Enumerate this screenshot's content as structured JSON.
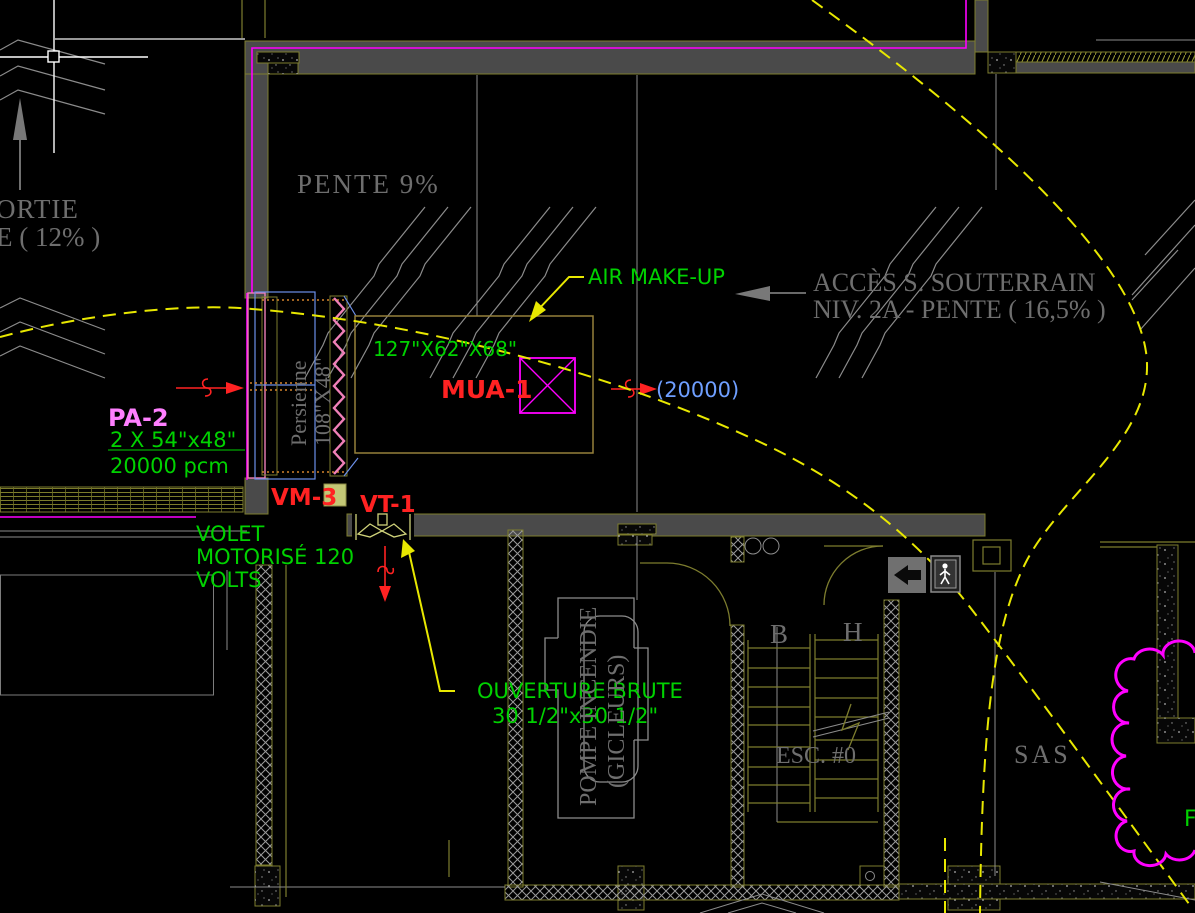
{
  "colors": {
    "bg": "#000000",
    "wall": "#4a4a4a",
    "olive": "#7d7d2e",
    "tan": "#95803a",
    "grayline": "#8c8c8c",
    "graytext": "#6e6e6e",
    "green": "#00d200",
    "red": "#ff2222",
    "violet": "#ff7fff",
    "bluetext": "#6f9fff",
    "blueline": "#6c8fe8",
    "pink": "#f080b8",
    "magenta": "#ff00ff",
    "yellow": "#e8e800",
    "khaki": "#cfd27a",
    "white": "#ffffff"
  },
  "labels": {
    "sortie_partial": "ORTIE",
    "pente12_partial": "E  ( 12% )",
    "pente9": "PENTE  9%",
    "acces_line1": "ACCÈS S. SOUTERRAIN",
    "acces_line2": "NIV. 2A  -  PENTE ( 16,5% )",
    "air_make_up": "AIR MAKE-UP",
    "mua_dims": "127\"X62\"X68\"",
    "mua_tag": "MUA-1",
    "mua_flow": "(20000)",
    "pa2_tag": "PA-2",
    "pa2_size": "2 X 54\"x48\"",
    "pa2_flow": "20000 pcm",
    "vm3_tag": "VM-3",
    "vt1_tag": "VT-1",
    "volet_line1": "VOLET",
    "volet_line2": "MOTORISÉ 120",
    "volet_line3": "VOLTS",
    "ouverture_line1": "OUVERTURE BRUTE",
    "ouverture_line2": "30 1/2\"x30 1/2\"",
    "persienne_line1": "Persienne",
    "persienne_line2": "108\"X48\"",
    "pompe_line1": "POMPE INCENDIE",
    "pompe_line2": "(GICLEURS)",
    "stair_b": "B",
    "stair_h": "H",
    "esc_tag": "ESC. #0",
    "sas": "SAS",
    "rev_partial": "F"
  }
}
